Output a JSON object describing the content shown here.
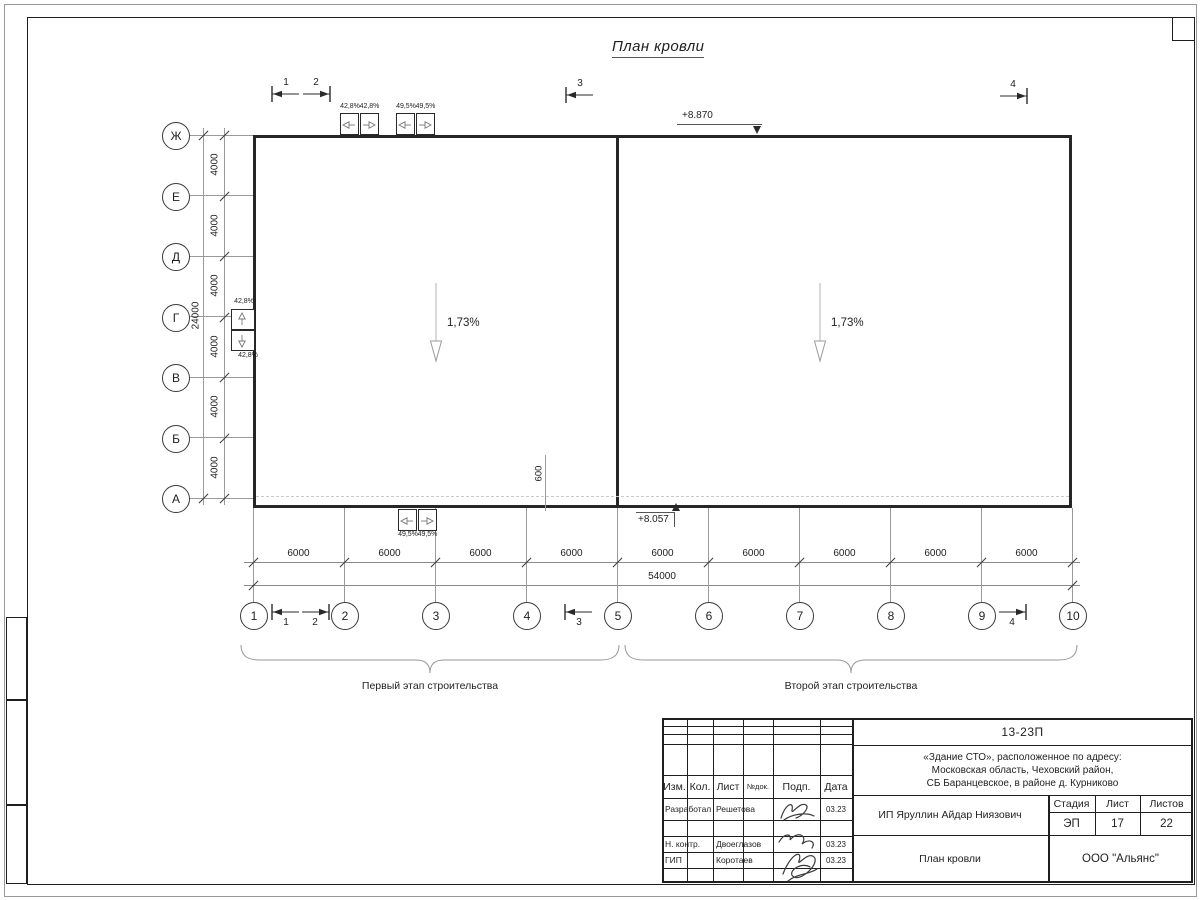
{
  "page": {
    "title": "План кровли"
  },
  "building": {
    "elevation_top": "+8.870",
    "elevation_bottom": "+8.057",
    "slope_left": "1,73%",
    "slope_right": "1,73%",
    "offset_dim": "600"
  },
  "grid": {
    "row_axes": [
      "Ж",
      "Е",
      "Д",
      "Г",
      "В",
      "Б",
      "А"
    ],
    "col_axes": [
      "1",
      "2",
      "3",
      "4",
      "5",
      "6",
      "7",
      "8",
      "9",
      "10"
    ],
    "row_dims": [
      "4000",
      "4000",
      "4000",
      "4000",
      "4000",
      "4000"
    ],
    "row_total": "24000",
    "col_dims": [
      "6000",
      "6000",
      "6000",
      "6000",
      "6000",
      "6000",
      "6000",
      "6000",
      "6000"
    ],
    "col_total": "54000"
  },
  "sections": {
    "top": [
      "1",
      "2",
      "3",
      "4"
    ],
    "bottom": [
      "1",
      "2",
      "3",
      "4"
    ]
  },
  "funnels": {
    "top_left_labels": [
      "42,8%",
      "42,8%"
    ],
    "top_right_labels": [
      "49,5%",
      "49,5%"
    ],
    "bottom_labels": [
      "49,5%",
      "49,5%"
    ],
    "side_labels": [
      "42,8%",
      "42,8%"
    ]
  },
  "stages": {
    "first": "Первый этап строительства",
    "second": "Второй этап строительства"
  },
  "titleblock": {
    "doc_number": "13-23П",
    "project_line1": "«Здание СТО», расположенное по адресу:",
    "project_line2": "Московская область, Чеховский район,",
    "project_line3": "СБ Баранцевское, в районе д. Курниково",
    "header": [
      "Изм.",
      "Кол.",
      "Лист",
      "№док.",
      "Подп.",
      "Дата"
    ],
    "sign_rows": [
      {
        "role": "Разработал",
        "name": "Решетова",
        "date": "03.23"
      },
      {
        "role": "",
        "name": "",
        "date": ""
      },
      {
        "role": "Н. контр.",
        "name": "Двоеглазов",
        "date": "03.23"
      },
      {
        "role": "ГИП",
        "name": "Коротаев",
        "date": "03.23"
      },
      {
        "role": "",
        "name": "",
        "date": ""
      }
    ],
    "client": "ИП Яруллин Айдар Ниязович",
    "stage_header": [
      "Стадия",
      "Лист",
      "Листов"
    ],
    "stage_values": [
      "ЭП",
      "17",
      "22"
    ],
    "drawing_title": "План кровли",
    "company": "ООО \"Альянс\""
  },
  "colors": {
    "ink": "#1f1f1f",
    "thin_line": "#9a9a9a",
    "dashed_line": "#c9c9c9"
  }
}
